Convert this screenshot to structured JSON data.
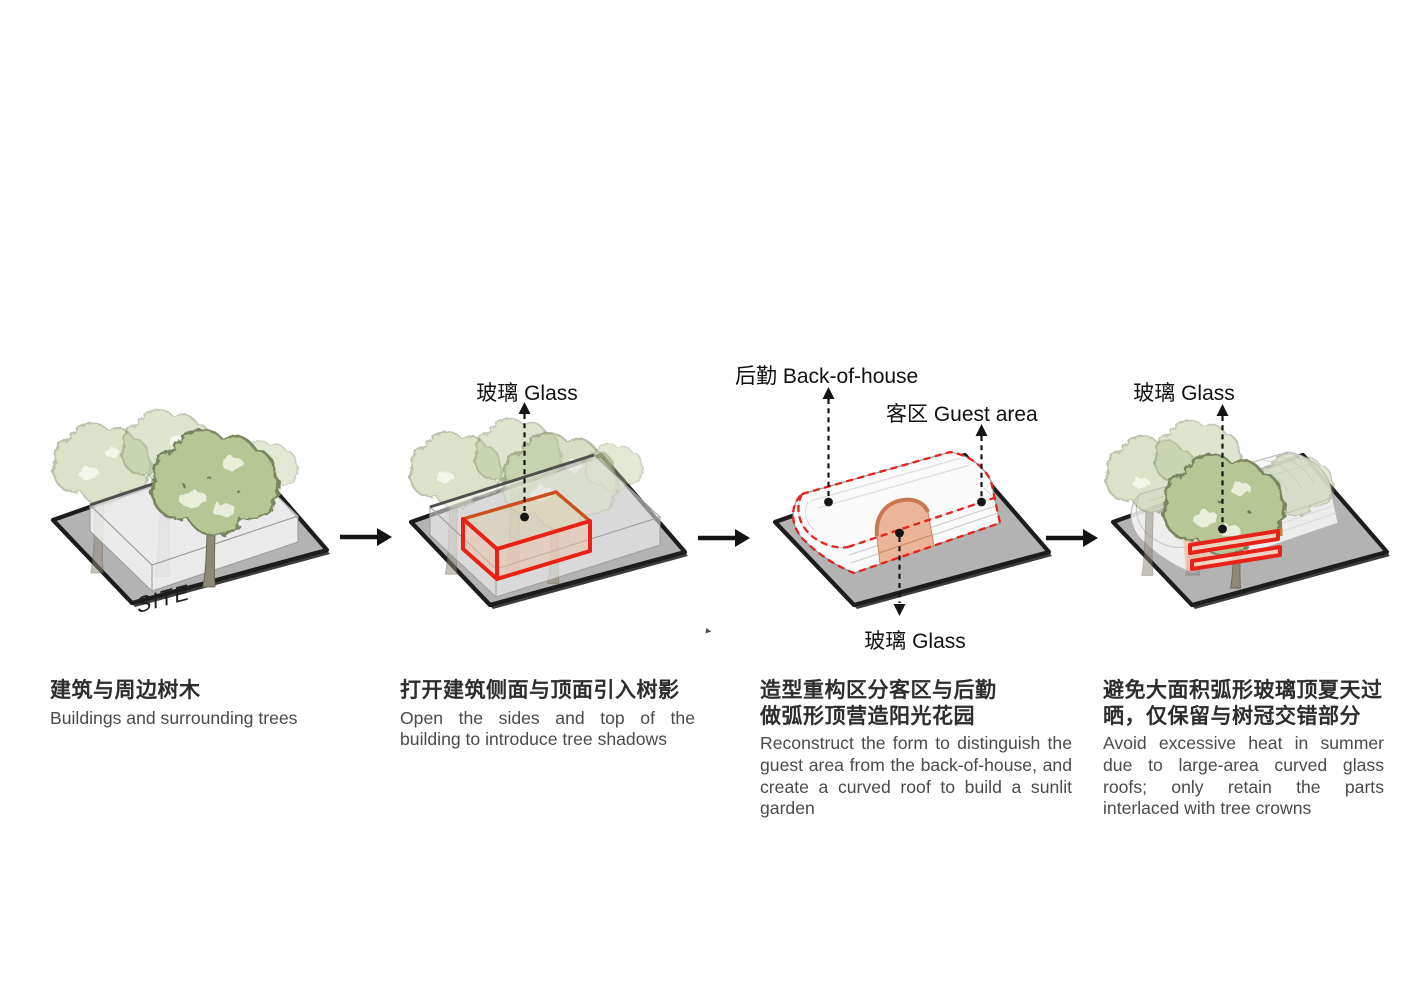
{
  "page": {
    "background": "#ffffff"
  },
  "panels": [
    {
      "id": "site",
      "site_label": "SITE",
      "heading_zh": [
        "建筑与周边树木"
      ],
      "caption_en": "Buildings and surrounding trees"
    },
    {
      "id": "open-building",
      "annotations": {
        "glass_top": "玻璃 Glass"
      },
      "heading_zh": [
        "打开建筑侧面与顶面引入树影"
      ],
      "caption_en": "Open the sides and top of the building to introduce tree shadows"
    },
    {
      "id": "reconstruct-form",
      "annotations": {
        "back_of_house": "后勤 Back-of-house",
        "guest_area": "客区 Guest area",
        "glass_bottom": "玻璃 Glass"
      },
      "heading_zh": [
        "造型重构区分客区与后勤",
        "做弧形顶营造阳光花园"
      ],
      "caption_en": "Reconstruct the form to distinguish the guest area from the back-of-house, and create a curved roof to build a sunlit garden"
    },
    {
      "id": "avoid-heat",
      "annotations": {
        "glass_top": "玻璃 Glass"
      },
      "heading_zh": [
        "避免大面积弧形玻璃顶夏天过",
        "晒，仅保留与树冠交错部分"
      ],
      "caption_en": "Avoid excessive heat in summer due to large-area curved glass roofs; only retain the parts interlaced with tree crowns"
    }
  ],
  "colors": {
    "site_gray": "#b3b3b3",
    "border_black": "#1c1c1c",
    "tree_green": "#b6c694",
    "tree_rim": "#7a8660",
    "tree_light_patch": "#e8eed9",
    "trunk_brown": "#8f8876",
    "highlight_red": "#e6221a",
    "highlight_orange": "#cc5a20",
    "glass_pink": "#f0bfa6",
    "vault_pink": "#e9b194",
    "text_dark": "#2d2d2d",
    "text_gray": "#4a4a4a"
  }
}
